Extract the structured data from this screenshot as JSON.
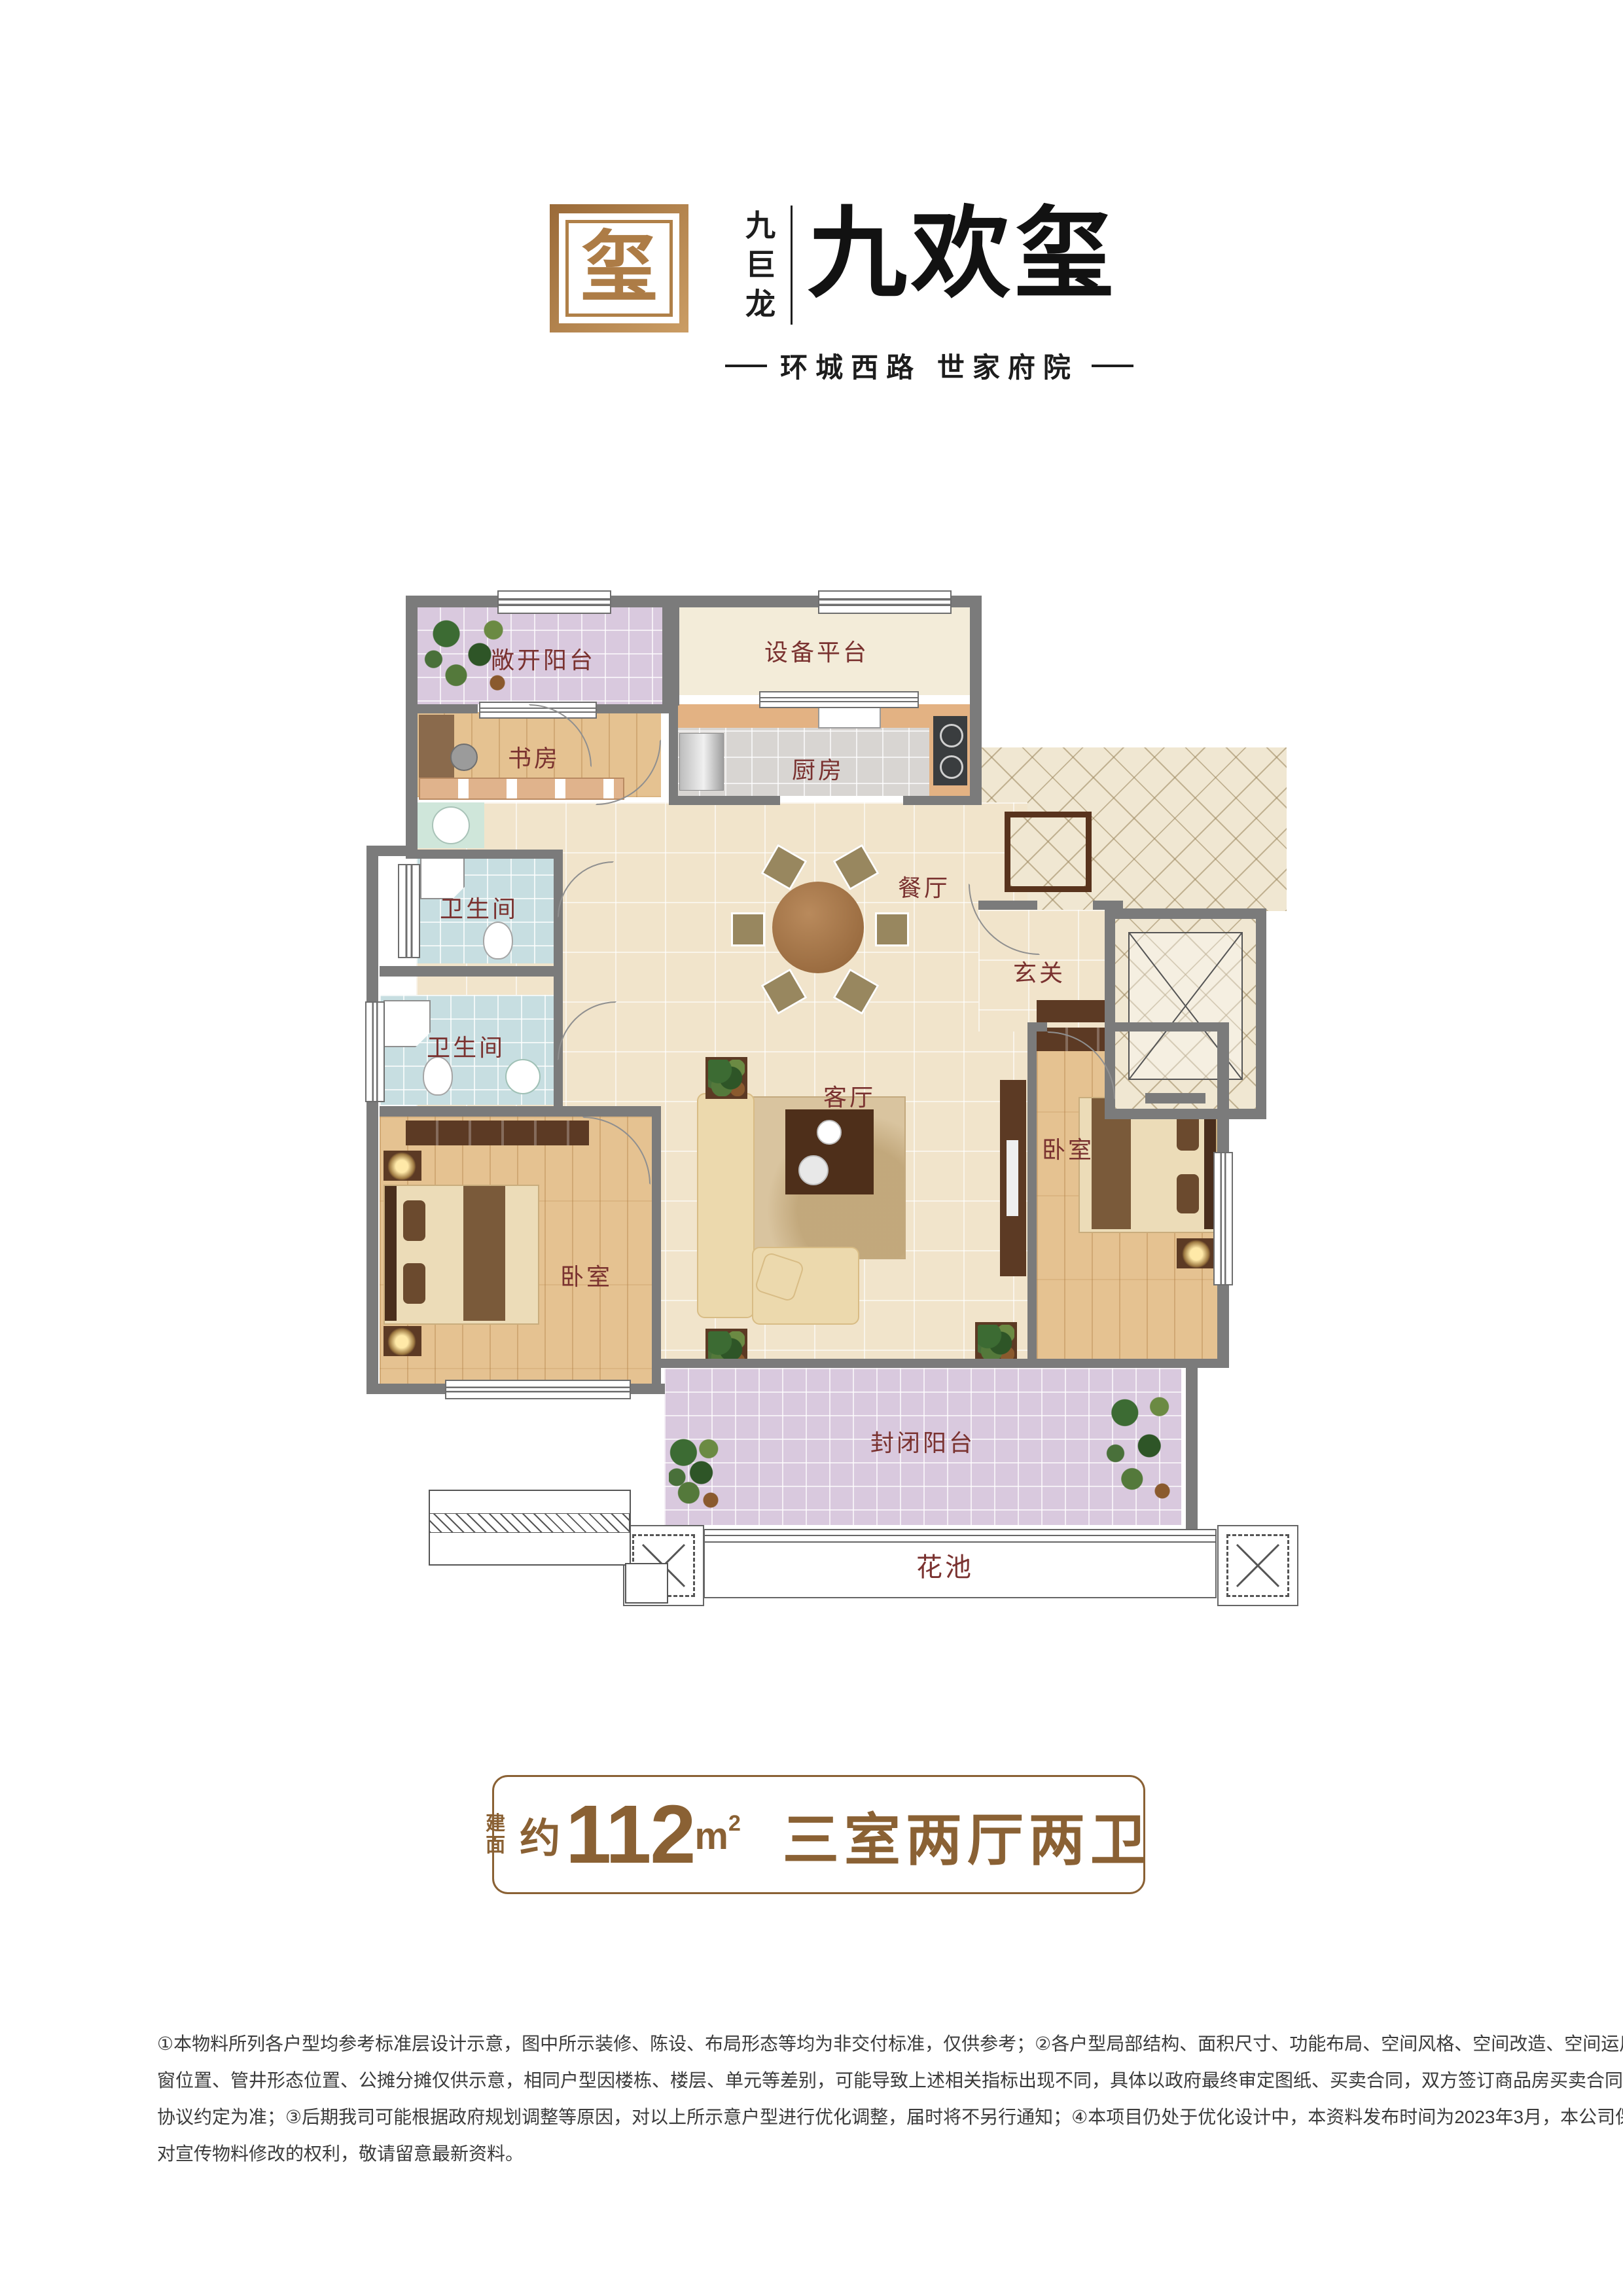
{
  "brand": {
    "seal_glyph": "玺",
    "company": "九巨龙",
    "project_name": "九欢玺",
    "tagline": "环城西路  世家府院"
  },
  "floorplan": {
    "rooms": {
      "open_balcony": "敞开阳台",
      "equipment_platform": "设备平台",
      "study": "书房",
      "kitchen": "厨房",
      "dining": "餐厅",
      "foyer": "玄关",
      "bathroom_upper": "卫生间",
      "bathroom_lower": "卫生间",
      "living": "客厅",
      "bedroom_left": "卧室",
      "bedroom_right": "卧室",
      "closed_balcony": "封闭阳台",
      "flower_bed": "花池"
    }
  },
  "area_badge": {
    "label_line1": "建",
    "label_line2": "面",
    "approx": "约",
    "area_value": "112",
    "area_unit": "m",
    "area_unit_sup": "2",
    "layout_text": "三室两厅两卫"
  },
  "disclaimer": {
    "lines": [
      "①本物料所列各户型均参考标准层设计示意，图中所示装修、陈设、布局形态等均为非交付标准，仅供参考；②各户型局部结构、面积尺寸、功能布局、空间风格、空间改造、空间运用、门",
      "窗位置、管井形态位置、公摊分摊仅供示意，相同户型因楼栋、楼层、单元等差别，可能导致上述相关指标出现不同，具体以政府最终审定图纸、买卖合同，双方签订商品房买卖合同及补充",
      "协议约定为准；③后期我司可能根据政府规划调整等原因，对以上所示意户型进行优化调整，届时将不另行通知；④本项目仍处于优化设计中，本资料发布时间为2023年3月，本公司保留",
      "对宣传物料修改的权利，敬请留意最新资料。"
    ]
  },
  "colors": {
    "gold": "#b08048",
    "label_maroon": "#7a3230",
    "badge_brown": "#8a6134",
    "wall_gray": "#7b7b7b"
  }
}
